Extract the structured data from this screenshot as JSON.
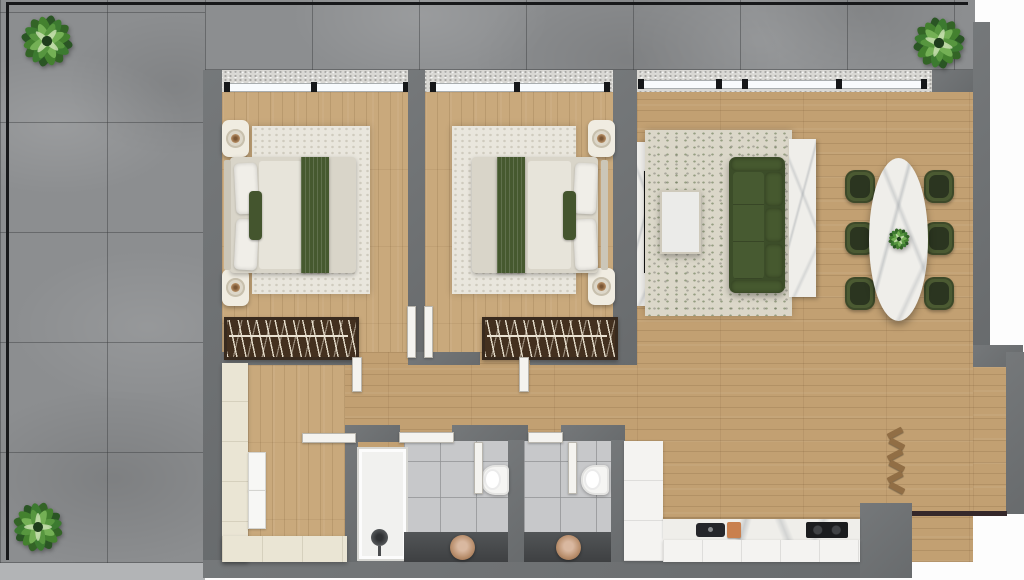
{
  "scene": {
    "title": "Apartment floor plan — top-down 3D render",
    "rooms": {
      "terrace": {
        "label": "Terrace",
        "floor": "grey stone tiles",
        "items": [
          "potted plant top-left",
          "potted plant top-right",
          "potted plant bottom-left",
          "railing"
        ]
      },
      "bedroom1": {
        "label": "Bedroom 1",
        "floor": "oak parquet",
        "items": [
          "double bed with white linen and green throw",
          "nightstand with lamp x2",
          "cream area rug",
          "open wardrobe rail with hangers",
          "window"
        ]
      },
      "bedroom2": {
        "label": "Bedroom 2",
        "floor": "oak parquet",
        "items": [
          "double bed with white linen and green throw",
          "nightstand with lamp x2",
          "cream area rug",
          "open wardrobe rail with hangers",
          "window"
        ]
      },
      "living": {
        "label": "Living room",
        "floor": "oak parquet",
        "items": [
          "green three-seat sofa",
          "white coffee table",
          "TV console with TV",
          "patterned area rug",
          "marble console behind sofa",
          "decorative wooden ladder"
        ]
      },
      "dining": {
        "label": "Dining area",
        "items": [
          "oval white-marble dining table",
          "six green dining chairs",
          "plant centerpiece"
        ]
      },
      "hall": {
        "label": "Hallway / entry",
        "items": [
          "built-in cream cabinet run",
          "stacked appliances",
          "internal doors"
        ]
      },
      "bath1": {
        "label": "Bathroom 1",
        "items": [
          "walk-in shower",
          "toilet",
          "dark vanity with round basin"
        ]
      },
      "bath2": {
        "label": "Bathroom 2",
        "items": [
          "toilet",
          "dark vanity with round basin"
        ]
      },
      "kitchen": {
        "label": "Kitchen",
        "items": [
          "marble counter with sink",
          "copper cutting board",
          "black cooktop",
          "tall white cabinet"
        ]
      }
    },
    "palette": {
      "terrace_tile": "#8c8e90",
      "wall_grey": "#6f7274",
      "wood_floor": "#c6a476",
      "bedroom_rug": "#e9e6dd",
      "living_rug": "#dbd7c9",
      "sofa_green": "#3d4e2a",
      "accent_green": "#44552e",
      "marble_white": "#efeeea",
      "bathroom_tile": "#c7c8ca",
      "vanity_dark": "#4a4c4e",
      "cabinet_cream": "#eae5d4",
      "cutting_board_copper": "#c9804e",
      "wardrobe_brown": "#43301f"
    }
  }
}
